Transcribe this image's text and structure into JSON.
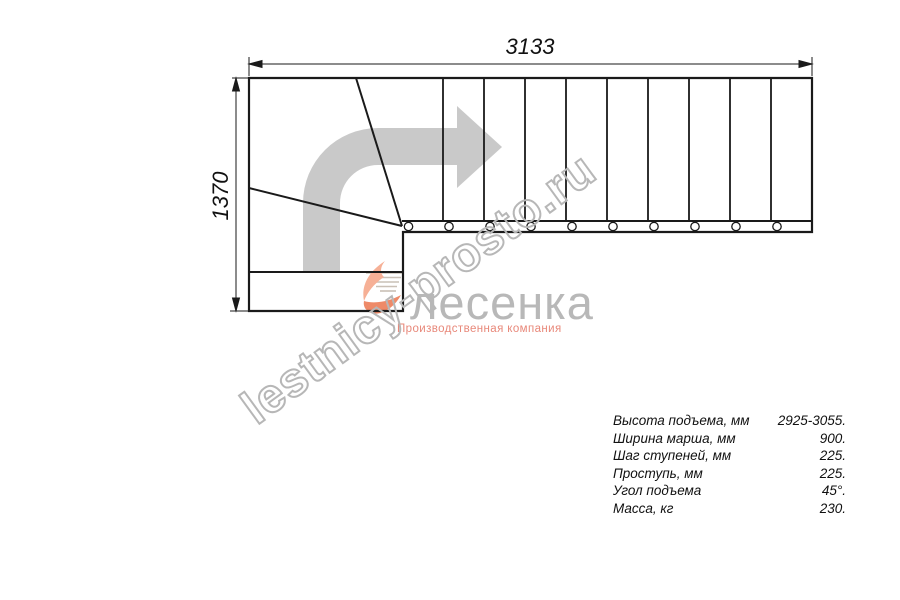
{
  "drawing": {
    "dim_width_label": "3133",
    "dim_height_label": "1370",
    "line_color": "#1a1a1a",
    "arrow_color": "#c9c9c9"
  },
  "watermark": {
    "text": "lestnicy-prosto.ru",
    "outline_color": "#b7b7b7"
  },
  "logo": {
    "name": "лесенка",
    "tagline": "Производственная компания",
    "name_color": "#b8b8b8",
    "tagline_color": "#e8887a",
    "swoosh_color": "#ee8a68",
    "swoosh_light_color": "#f6b096"
  },
  "specs": {
    "rows": [
      {
        "label": "Высота подъема, мм",
        "value": "2925-3055."
      },
      {
        "label": "Ширина марша, мм",
        "value": "900."
      },
      {
        "label": "Шаг ступеней, мм",
        "value": "225."
      },
      {
        "label": "Проступь, мм",
        "value": "225."
      },
      {
        "label": "Угол подъема",
        "value": "45°."
      },
      {
        "label": "Масса, кг",
        "value": "230."
      }
    ]
  }
}
